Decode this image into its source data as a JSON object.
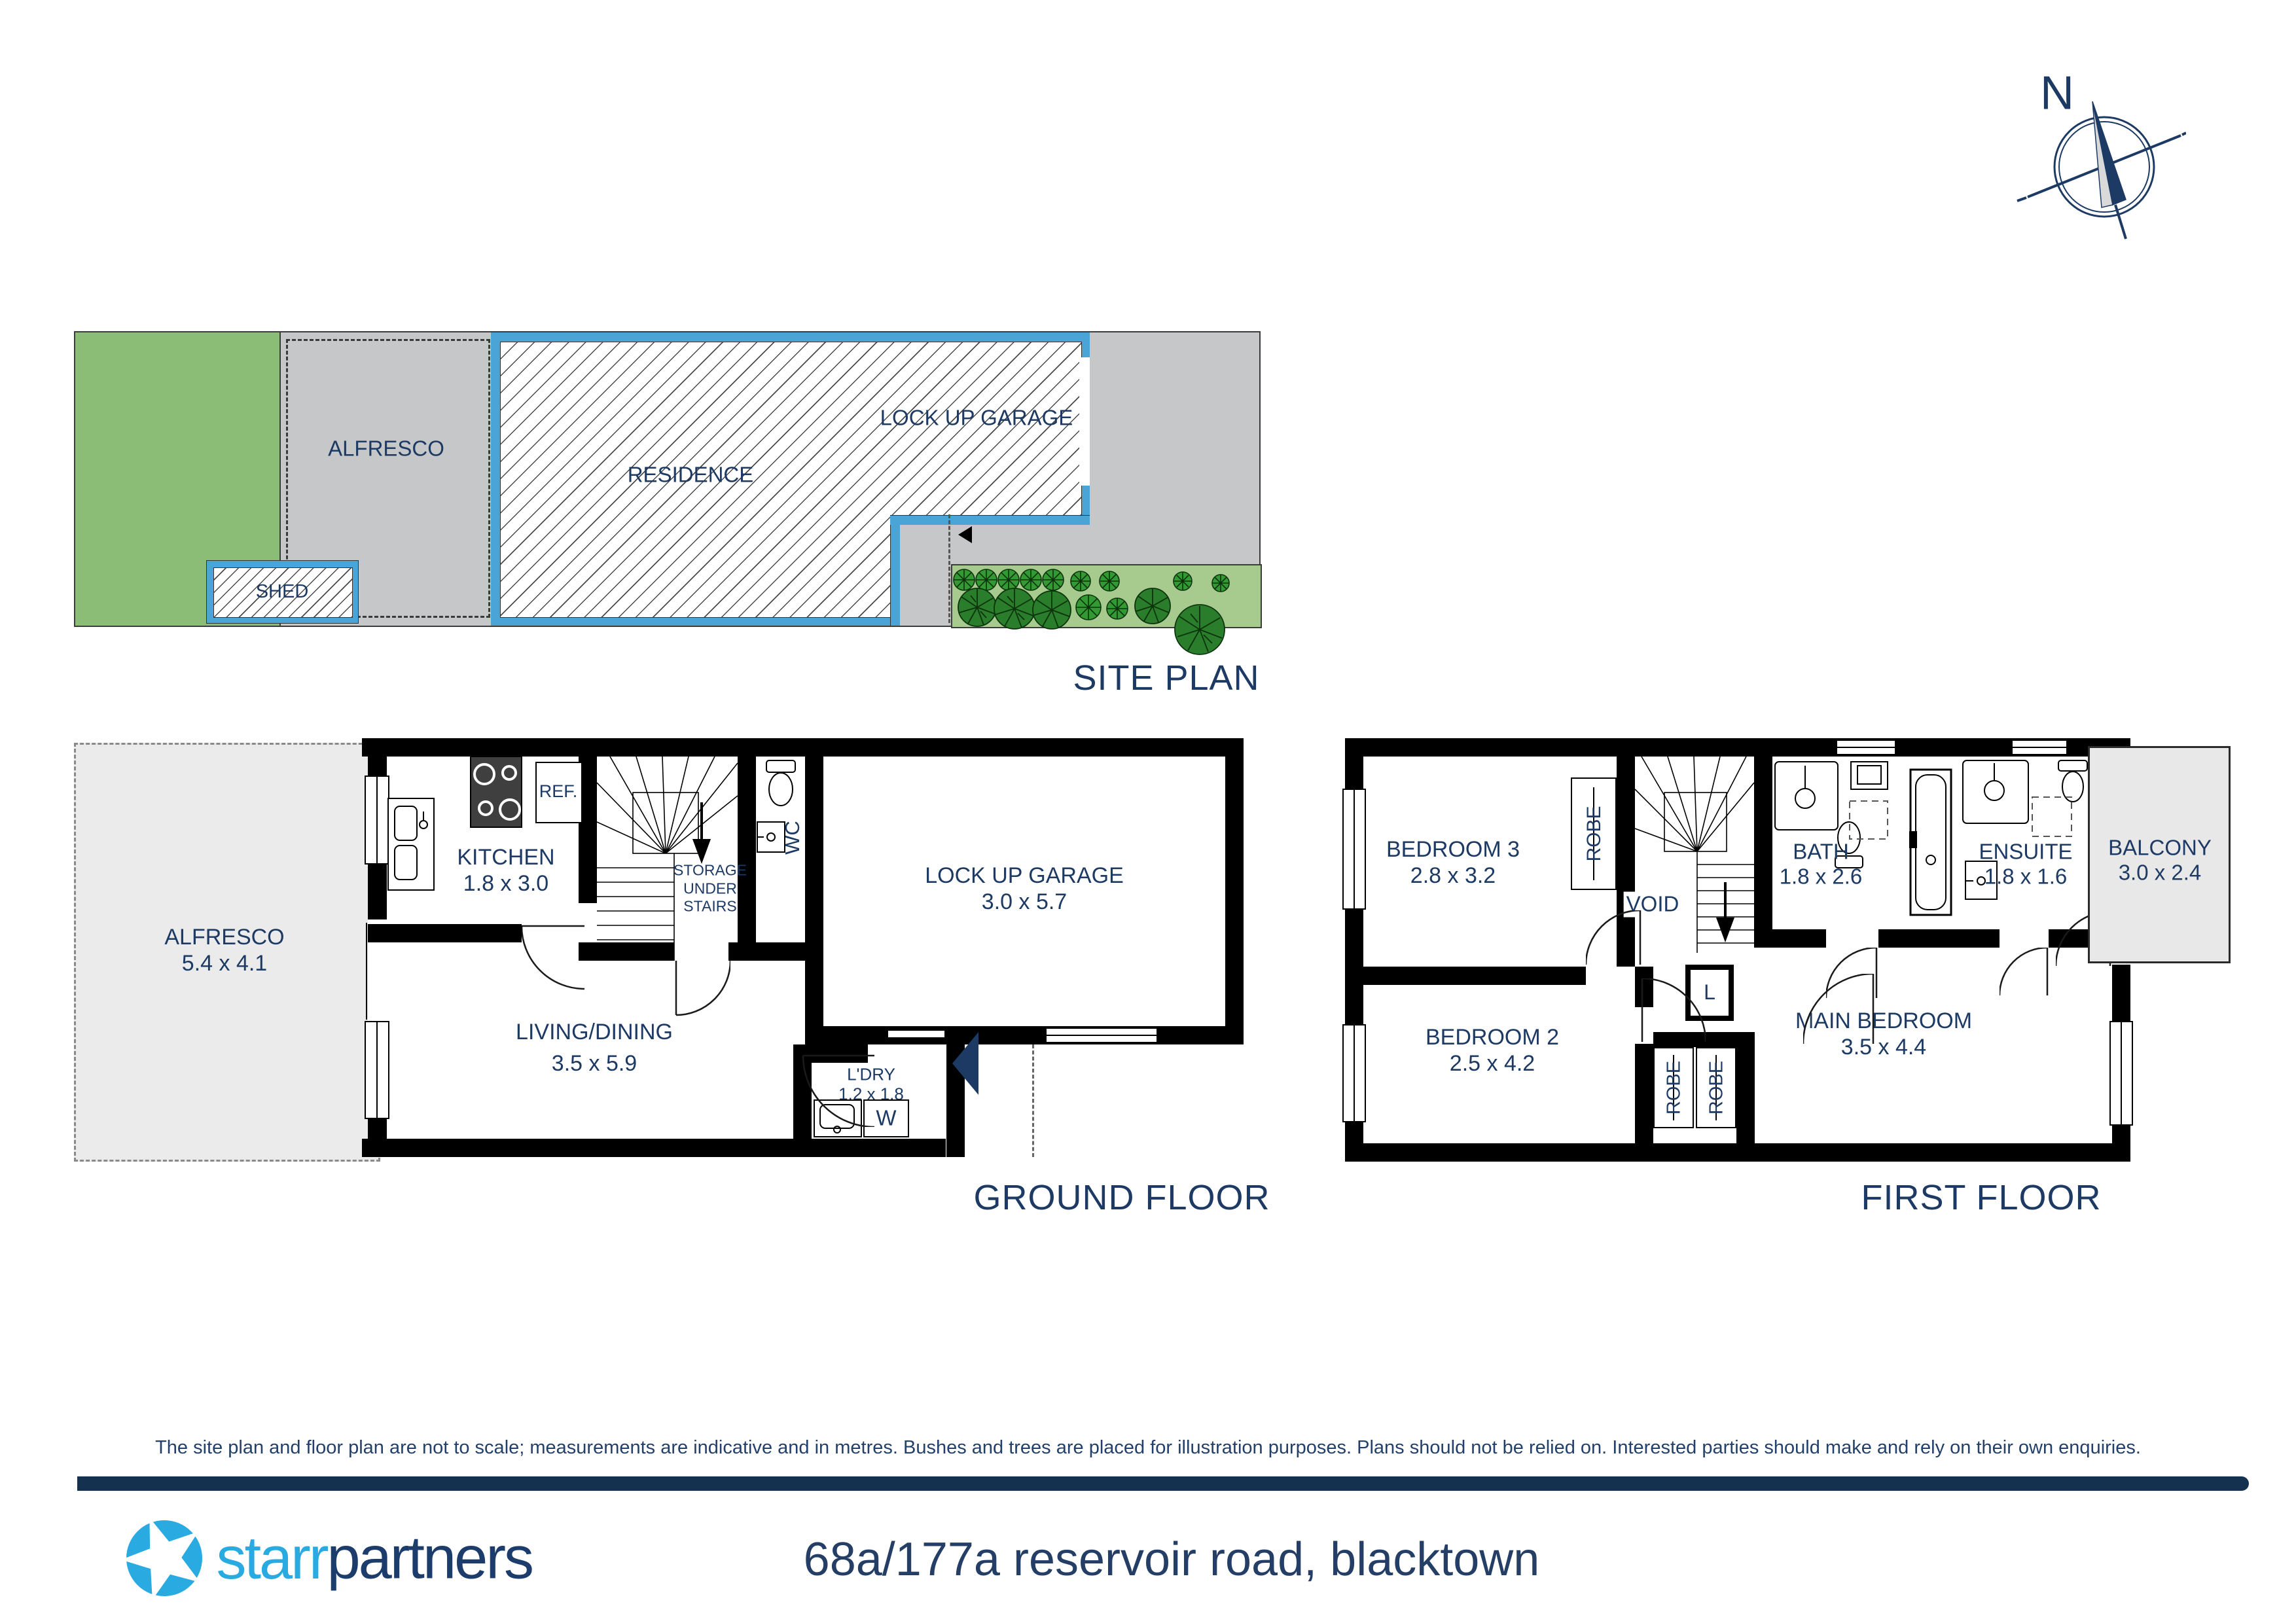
{
  "compass": {
    "north": "N"
  },
  "site_plan": {
    "title": "SITE PLAN",
    "labels": {
      "alfresco": "ALFRESCO",
      "residence": "RESIDENCE",
      "garage": "LOCK UP GARAGE",
      "shed": "SHED"
    }
  },
  "ground_floor": {
    "title": "GROUND FLOOR",
    "alfresco": {
      "name": "ALFRESCO",
      "dims": "5.4 x 4.1"
    },
    "kitchen": {
      "name": "KITCHEN",
      "dims": "1.8 x 3.0"
    },
    "fridge": "REF.",
    "storage": "STORAGE\nUNDER\nSTAIRS",
    "wc": "WC",
    "garage": {
      "name": "LOCK UP GARAGE",
      "dims": "3.0 x 5.7"
    },
    "living": {
      "name": "LIVING/DINING",
      "dims": "3.5 x 5.9"
    },
    "laundry": {
      "name": "L'DRY",
      "dims": "1.2 x 1.8"
    },
    "washer": "W"
  },
  "first_floor": {
    "title": "FIRST FLOOR",
    "bedroom3": {
      "name": "BEDROOM 3",
      "dims": "2.8 x 3.2"
    },
    "robe3": "ROBE",
    "void": "VOID",
    "bath": {
      "name": "BATH",
      "dims": "1.8 x 2.6"
    },
    "ensuite": {
      "name": "ENSUITE",
      "dims": "1.8 x 1.6"
    },
    "balcony": {
      "name": "BALCONY",
      "dims": "3.0 x 2.4"
    },
    "bedroom2": {
      "name": "BEDROOM 2",
      "dims": "2.5 x 4.2"
    },
    "main_bedroom": {
      "name": "MAIN BEDROOM",
      "dims": "3.5 x 4.4"
    },
    "linen": "L",
    "robe2": "ROBE",
    "robe_main": "ROBE"
  },
  "disclaimer": "The site plan and floor plan are not to scale; measurements are indicative and in metres. Bushes and trees are placed for illustration purposes. Plans should not be relied on. Interested parties should make and rely on their own enquiries.",
  "footer": {
    "brand_light": "starr",
    "brand_dark": "partners",
    "address": "68a/177a reservoir road, blacktown"
  },
  "colors": {
    "navy_text": "#1d3a64",
    "site_wall_blue": "#4aa5d6",
    "lawn_green": "#8cbd76",
    "garden_green": "#a7cb8e",
    "plot_gray": "#c6c7c8",
    "logo_blue": "#29abe2",
    "logo_navy": "#1c3c6c",
    "footer_bar_navy": "#14314f"
  }
}
